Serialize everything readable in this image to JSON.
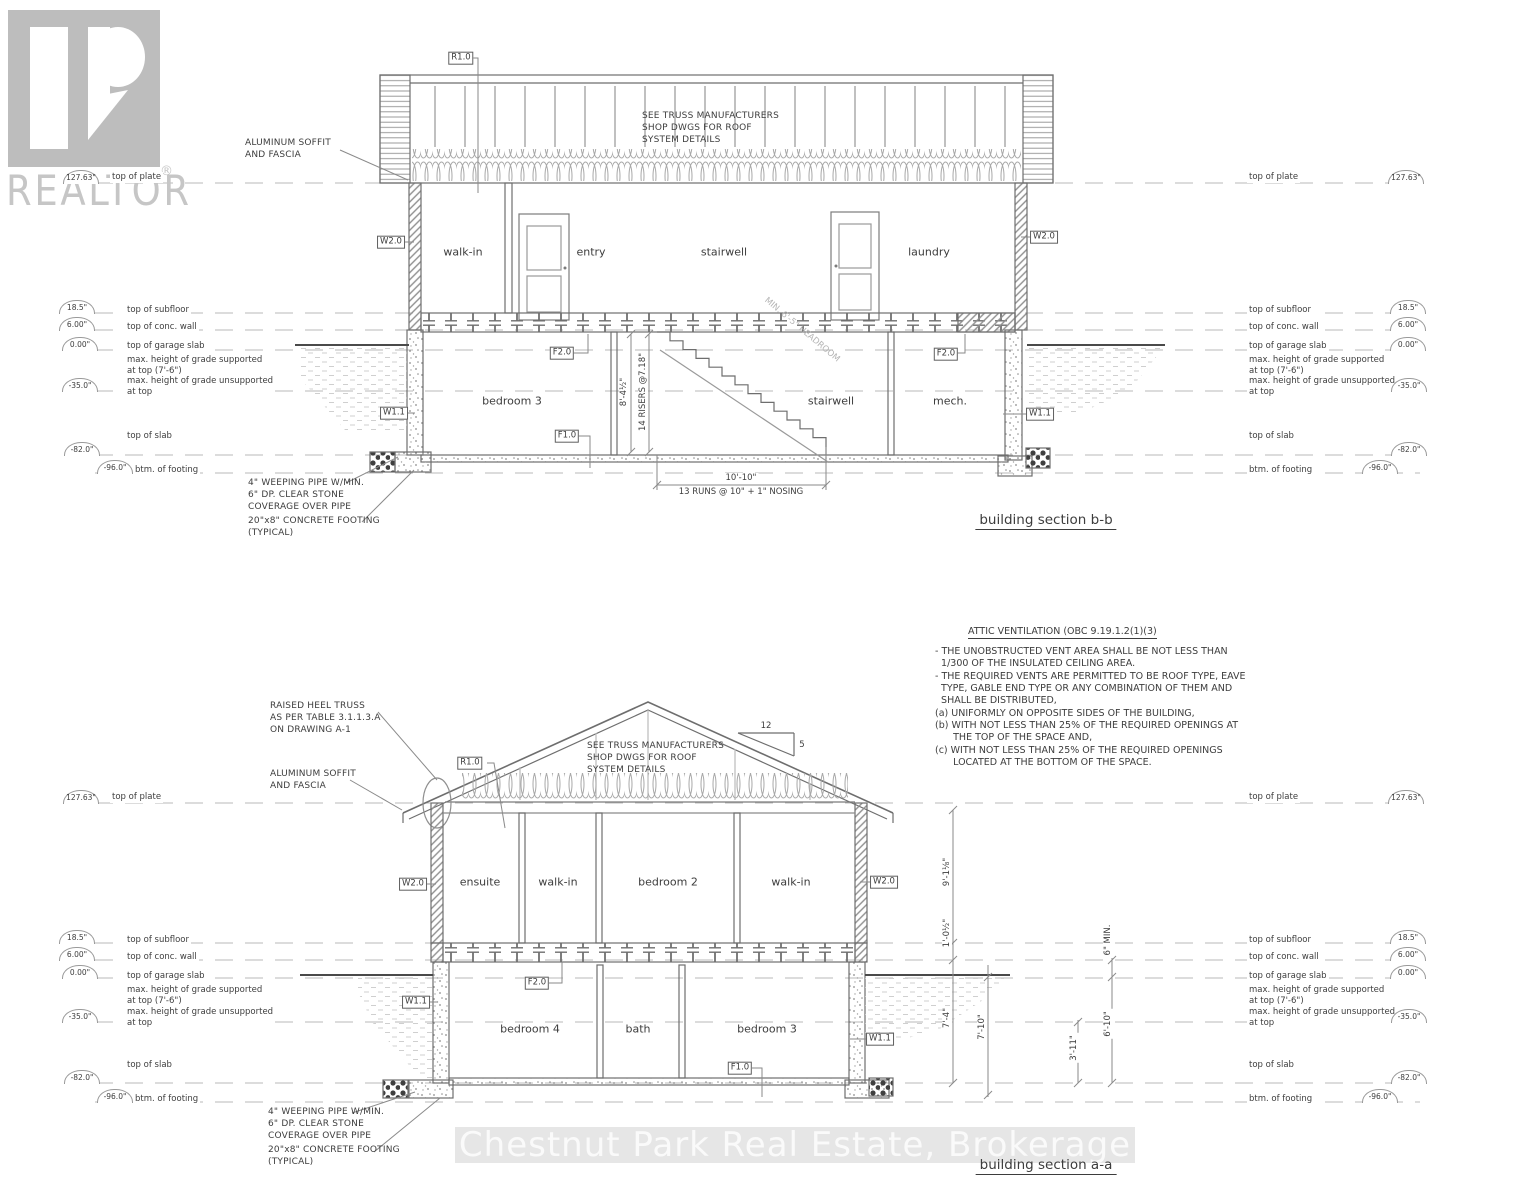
{
  "branding": {
    "logo_text": "REALTOR",
    "registered": "®"
  },
  "watermark": {
    "text": "Chestnut Park Real Estate, Brokerage"
  },
  "levels": {
    "plate": {
      "label": "top of plate",
      "elev": "127.63\""
    },
    "subfloor": {
      "label": "top of subfloor",
      "elev": "18.5\""
    },
    "conc_wall": {
      "label": "top of conc. wall",
      "elev": "6.00\""
    },
    "garage_slab": {
      "label": "top of garage slab",
      "elev": "0.00\""
    },
    "grade_supported": {
      "label": "max. height of grade supported\nat top (7'-6\")"
    },
    "grade_unsupported": {
      "label": "max. height of grade unsupported\nat top",
      "elev": "-35.0\""
    },
    "slab": {
      "label": "top of slab",
      "elev": "-82.0\""
    },
    "footing": {
      "label": "btm. of footing",
      "elev": "-96.0\""
    }
  },
  "tags": {
    "roof": "R1.0",
    "wall_main": "W2.0",
    "wall_bsmt": "W1.1",
    "floor_main": "F2.0",
    "floor_bsmt": "F1.0"
  },
  "notes": {
    "truss": "SEE TRUSS MANUFACTURERS\nSHOP DWGS FOR ROOF\nSYSTEM DETAILS",
    "soffit": "ALUMINUM SOFFIT\nAND FASCIA",
    "raised_heel": "RAISED HEEL TRUSS\nAS PER TABLE 3.1.1.3.A\nON DRAWING A-1",
    "weeping": "4\" WEEPING PIPE W/MIN.\n6\" DP. CLEAR STONE\nCOVERAGE OVER PIPE",
    "conc_footing": "20\"x8\" CONCRETE FOOTING\n(TYPICAL)",
    "headroom": "MIN. 6'-5\" HEADROOM"
  },
  "attic_vent": {
    "title": "ATTIC VENTILATION (OBC 9.19.1.2(1)(3)",
    "body": "- THE UNOBSTRUCTED VENT AREA SHALL BE NOT LESS THAN\n  1/300 OF THE INSULATED CEILING AREA.\n- THE REQUIRED VENTS ARE PERMITTED TO BE ROOF TYPE, EAVE\n  TYPE, GABLE END TYPE OR ANY COMBINATION OF THEM AND\n  SHALL BE DISTRIBUTED,\n(a) UNIFORMLY ON OPPOSITE SIDES OF THE BUILDING,\n(b) WITH NOT LESS THAN 25% OF THE REQUIRED OPENINGS AT\n      THE TOP OF THE SPACE AND,\n(c) WITH NOT LESS THAN 25% OF THE REQUIRED OPENINGS\n      LOCATED AT THE BOTTOM OF THE SPACE."
  },
  "section_b": {
    "title": "building section b-b",
    "rooms": {
      "main": [
        "walk-in",
        "entry",
        "stairwell",
        "laundry"
      ],
      "basement": [
        "bedroom 3",
        "stairwell",
        "mech."
      ]
    },
    "stairs": {
      "height": "8'-4½\"",
      "risers": "14 RISERS @7.18\"",
      "run": "10'-10\"",
      "run_note": "13 RUNS @ 10\" + 1\" NOSING"
    }
  },
  "section_a": {
    "title": "building section a-a",
    "rooms": {
      "main": [
        "ensuite",
        "walk-in",
        "bedroom 2",
        "walk-in"
      ],
      "basement": [
        "bedroom 4",
        "bath",
        "bedroom 3"
      ]
    },
    "slope": {
      "rise": "12",
      "run": "5"
    },
    "dims": {
      "plate_to_subfloor": "9'-1⅛\"",
      "subfloor_to_wall": "1'-0½\"",
      "wall_to_slab": "7'-4\"",
      "slab_to_footing": "7'-10\"",
      "grade_to_slab": "3'-11\"",
      "conc_min": "6\" MIN.",
      "garage_to_slab": "6'-10\""
    }
  }
}
